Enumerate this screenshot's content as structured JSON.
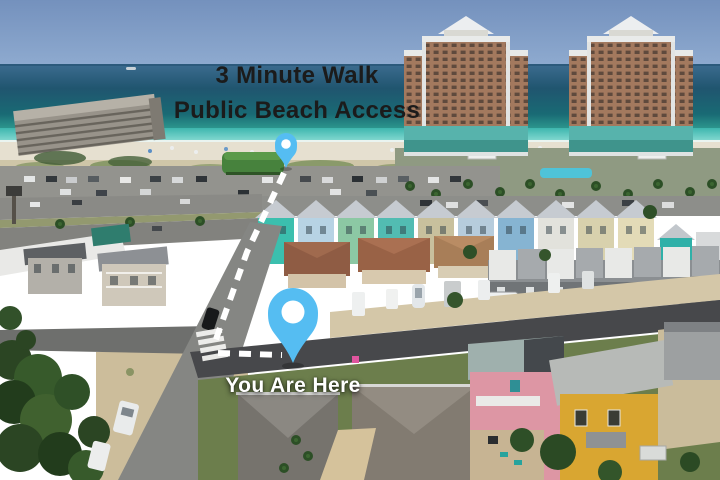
{
  "annotations": {
    "headline": {
      "line1": "3 Minute Walk",
      "line2": "Public Beach Access",
      "text_color": "#1b1b1b"
    },
    "you_are_here": {
      "label": "You Are Here",
      "text_color": "#ffffff"
    }
  },
  "map": {
    "destination_pin": {
      "icon": "map-pin-icon",
      "color": "#55bdf2",
      "dot_color": "#ffffff"
    },
    "origin_pin": {
      "icon": "map-pin-icon",
      "color": "#55bdf2",
      "dot_color": "#ffffff"
    },
    "route": {
      "style": "dashed",
      "color": "#ffffff"
    }
  },
  "palette": {
    "sky": "#7d9cc4",
    "ocean_deep": "#1f5573",
    "ocean_shallow": "#4fc3bb",
    "sand": "#e6e0d0"
  }
}
